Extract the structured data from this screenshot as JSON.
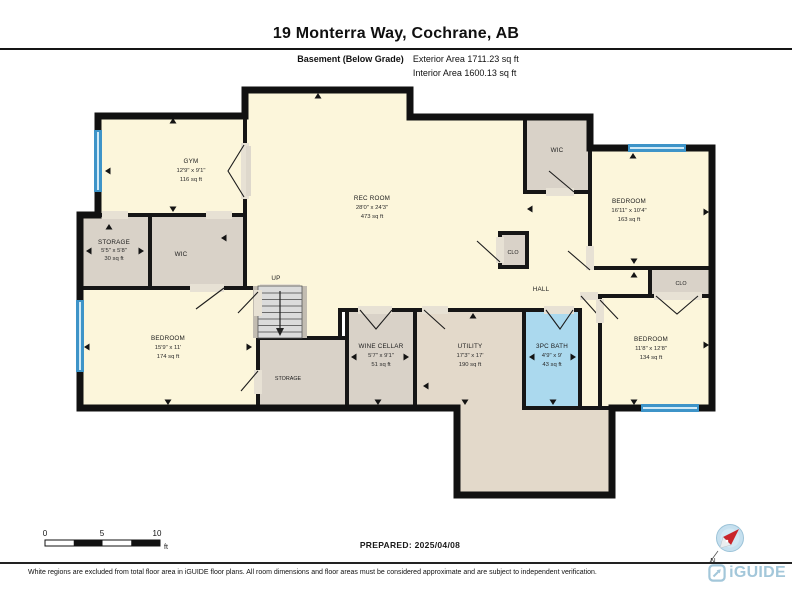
{
  "header": {
    "title": "19 Monterra Way, Cochrane, AB",
    "floor_label": "Basement (Below Grade)",
    "exterior_area": "Exterior Area 1711.23 sq ft",
    "interior_area": "Interior Area 1600.13 sq ft"
  },
  "rooms": {
    "gym": {
      "name": "GYM",
      "dims": "12'9\" x 9'1\"",
      "area": "116 sq ft"
    },
    "rec_room": {
      "name": "REC ROOM",
      "dims": "28'0\" x 24'3\"",
      "area": "473 sq ft"
    },
    "storage_left": {
      "name": "STORAGE",
      "dims": "5'5\" x 5'8\"",
      "area": "30 sq ft"
    },
    "wic_left": {
      "name": "WIC"
    },
    "bedroom_left": {
      "name": "BEDROOM",
      "dims": "15'9\" x 11'",
      "area": "174 sq ft"
    },
    "stairs": {
      "name": "UP"
    },
    "storage_under_stairs": {
      "name": "STORAGE"
    },
    "wine_cellar": {
      "name": "WINE CELLAR",
      "dims": "5'7\" x 9'1\"",
      "area": "51 sq ft"
    },
    "utility": {
      "name": "UTILITY",
      "dims": "17'3\" x 17'",
      "area": "190 sq ft"
    },
    "bath": {
      "name": "3PC BATH",
      "dims": "4'9\" x 9'",
      "area": "43 sq ft"
    },
    "hall": {
      "name": "HALL"
    },
    "clo_hall": {
      "name": "CLO"
    },
    "wic_right": {
      "name": "WIC"
    },
    "bedroom_right_upper": {
      "name": "BEDROOM",
      "dims": "16'11\" x 10'4\"",
      "area": "163 sq ft"
    },
    "clo_right": {
      "name": "CLO"
    },
    "bedroom_right_lower": {
      "name": "BEDROOM",
      "dims": "11'8\" x 12'8\"",
      "area": "134 sq ft"
    }
  },
  "scale": {
    "labels": [
      "0",
      "5",
      "10"
    ],
    "unit": "ft"
  },
  "compass": {
    "north_label": "N"
  },
  "footer": {
    "prepared": "PREPARED: 2025/04/08",
    "disclaimer": "White regions are excluded from total floor area in iGUIDE floor plans. All room dimensions and floor areas must be considered approximate and are subject to independent verification.",
    "brand": "iGUIDE"
  },
  "colors": {
    "room_fill": "#FCF6DB",
    "closet_fill": "#D9D2C8",
    "utility_fill": "#E3D9CA",
    "bath_fill": "#ABD9EE",
    "window_blue": "#3E94C8",
    "wall": "#111111",
    "brand_blue": "#A3C7DA",
    "compass_red": "#C9252B"
  }
}
